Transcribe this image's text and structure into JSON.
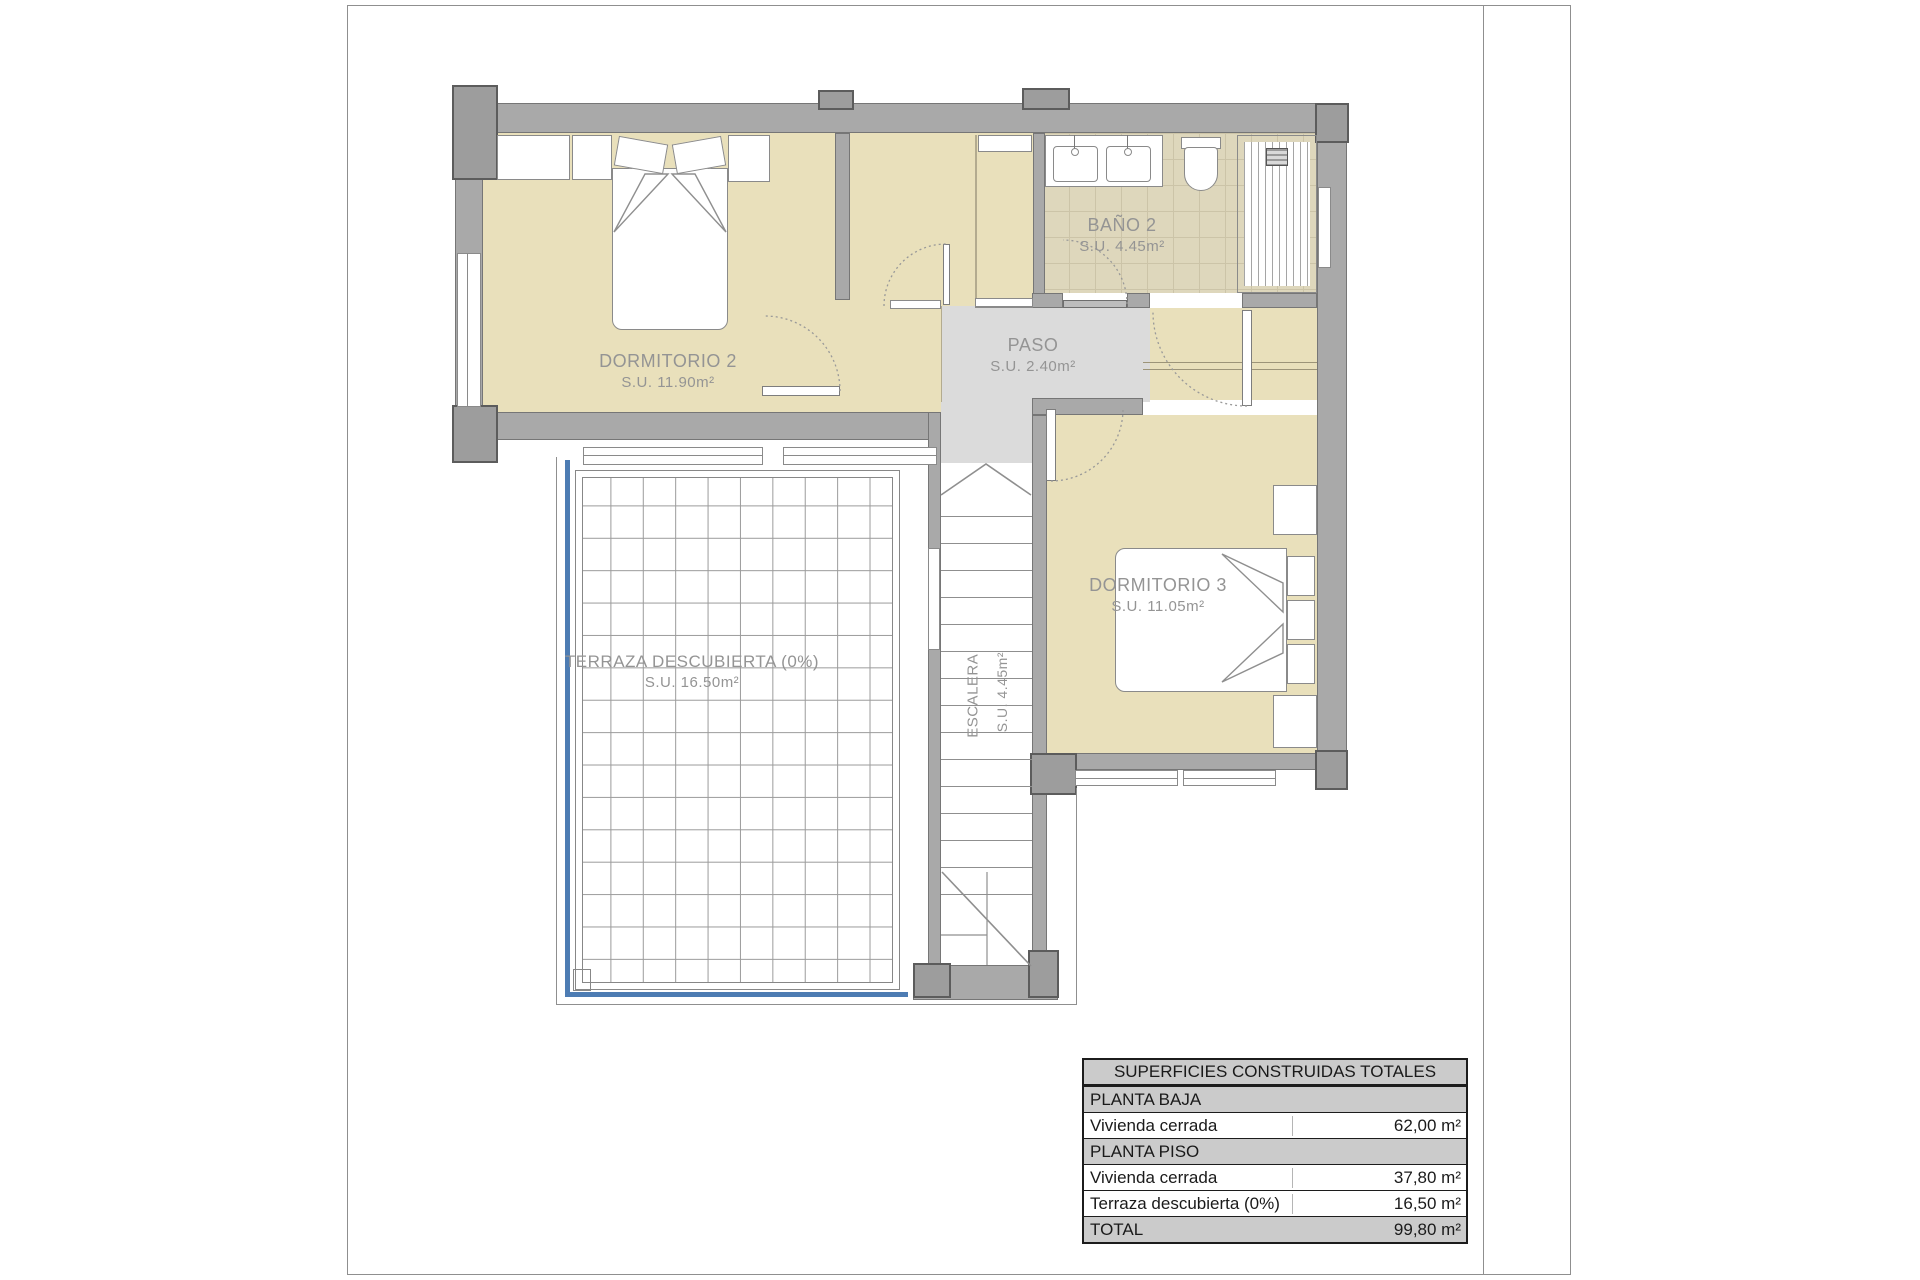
{
  "rooms": {
    "dormitorio2": {
      "name": "DORMITORIO 2",
      "area": "S.U. 11.90m²"
    },
    "bano2": {
      "name": "BAÑO 2",
      "area": "S.U. 4.45m²"
    },
    "paso": {
      "name": "PASO",
      "area": "S.U. 2.40m²"
    },
    "dormitorio3": {
      "name": "DORMITORIO 3",
      "area": "S.U. 11.05m²"
    },
    "terraza": {
      "name": "TERRAZA DESCUBIERTA (0%)",
      "area": "S.U. 16.50m²"
    },
    "escalera": {
      "name": "ESCALERA",
      "area": "S.U. 4.45m²"
    }
  },
  "table": {
    "title": "SUPERFICIES CONSTRUIDAS TOTALES",
    "rows": [
      {
        "label": "PLANTA BAJA",
        "value": "",
        "type": "section"
      },
      {
        "label": "Vivienda cerrada",
        "value": "62,00 m²",
        "type": "data"
      },
      {
        "label": "PLANTA PISO",
        "value": "",
        "type": "section"
      },
      {
        "label": "Vivienda cerrada",
        "value": "37,80 m²",
        "type": "data"
      },
      {
        "label": "Terraza descubierta (0%)",
        "value": "16,50 m²",
        "type": "data"
      },
      {
        "label": "TOTAL",
        "value": "99,80 m²",
        "type": "total"
      }
    ]
  },
  "colors": {
    "wall": "#a9a9a9",
    "room_fill": "#e9e0bb",
    "bath_tile": "#ded7bc",
    "corridor_fill": "#dbdbdb",
    "terrace_accent": "#4d7cb3",
    "table_header_bg": "#cbcbcb"
  }
}
